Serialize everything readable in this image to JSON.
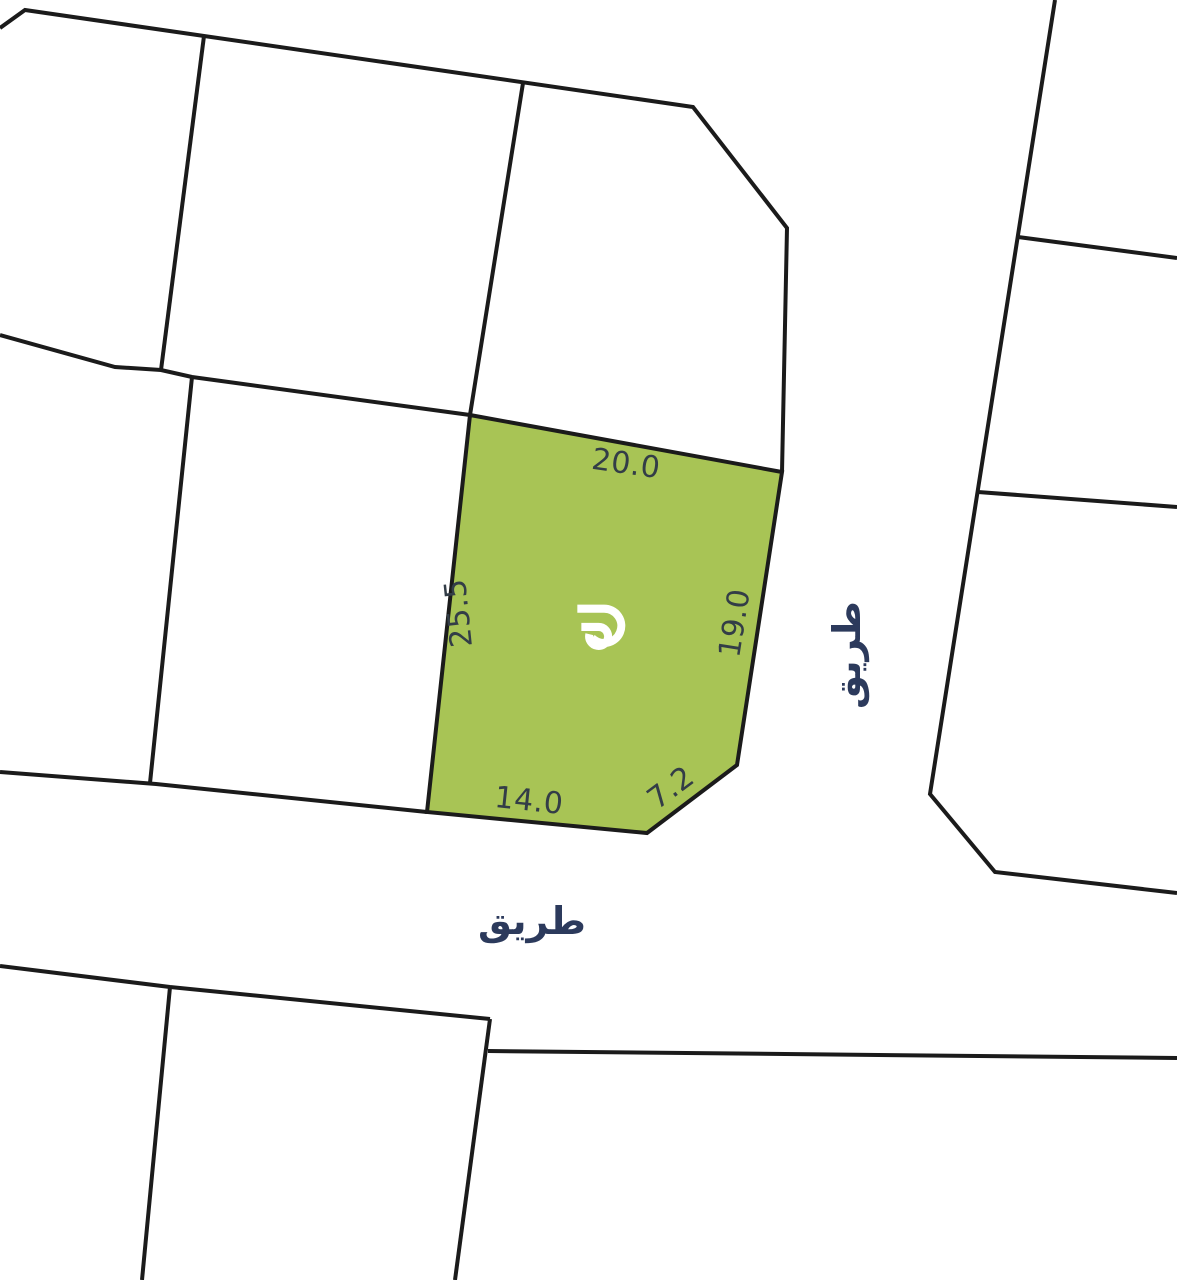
{
  "canvas": {
    "width": 1177,
    "height": 1280,
    "background": "#ffffff",
    "line_color": "#1b1b1b",
    "line_width": 4,
    "dimension_text_color": "#333d47",
    "road_text_color": "#2c3a5c"
  },
  "plot": {
    "name": "highlighted-parcel",
    "fill": "#a8c455",
    "polygon": [
      [
        470,
        415
      ],
      [
        782,
        472
      ],
      [
        737,
        765
      ],
      [
        647,
        833
      ],
      [
        427,
        812
      ]
    ],
    "logo": {
      "icon": "gp-monogram-icon",
      "color": "#ffffff",
      "x": 562,
      "y": 597,
      "size": 73
    },
    "dimensions": {
      "north": {
        "text": "20.0",
        "value": 20.0,
        "x": 626,
        "y": 464,
        "rot": 8
      },
      "west": {
        "text": "25.5",
        "value": 25.5,
        "x": 459,
        "y": 613,
        "rot": -96
      },
      "east": {
        "text": "19.0",
        "value": 19.0,
        "x": 735,
        "y": 623,
        "rot": -81
      },
      "south": {
        "text": "14.0",
        "value": 14.0,
        "x": 529,
        "y": 801,
        "rot": 6
      },
      "southeast": {
        "text": "7.2",
        "value": 7.2,
        "x": 671,
        "y": 788,
        "rot": -37
      }
    }
  },
  "roads": {
    "south": {
      "text": "طريق",
      "x": 532,
      "y": 921,
      "rot": 0,
      "size": 38
    },
    "east": {
      "text": "طريق",
      "x": 847,
      "y": 655,
      "rot": -90,
      "size": 38
    }
  },
  "geometry": {
    "boundaries": [
      {
        "name": "north-block-outline",
        "points": [
          [
            0,
            28
          ],
          [
            25,
            10
          ],
          [
            693,
            107
          ],
          [
            787,
            228
          ],
          [
            782,
            472
          ]
        ]
      },
      {
        "name": "north-parcel-divider-1",
        "points": [
          [
            204,
            36
          ],
          [
            161,
            370
          ]
        ]
      },
      {
        "name": "north-parcel-divider-2",
        "points": [
          [
            523,
            83
          ],
          [
            470,
            415
          ]
        ]
      },
      {
        "name": "mid-west-boundary",
        "points": [
          [
            0,
            335
          ],
          [
            115,
            367
          ],
          [
            161,
            370
          ],
          [
            192,
            377
          ],
          [
            470,
            415
          ]
        ]
      },
      {
        "name": "west-parcel-divider",
        "points": [
          [
            192,
            377
          ],
          [
            150,
            783
          ]
        ]
      },
      {
        "name": "road-south-upper-edge",
        "points": [
          [
            0,
            772
          ],
          [
            156,
            784
          ],
          [
            427,
            812
          ]
        ]
      },
      {
        "name": "road-south-lower-edge",
        "points": [
          [
            0,
            966
          ],
          [
            170,
            987
          ],
          [
            490,
            1019
          ]
        ]
      },
      {
        "name": "southwest-block-east-edge",
        "points": [
          [
            490,
            1019
          ],
          [
            455,
            1280
          ]
        ]
      },
      {
        "name": "southeast-block-top-edge",
        "points": [
          [
            488,
            1051
          ],
          [
            1177,
            1058
          ]
        ]
      },
      {
        "name": "southwest-parcel-divider",
        "points": [
          [
            170,
            987
          ],
          [
            142,
            1280
          ]
        ]
      },
      {
        "name": "east-block-west-edge",
        "points": [
          [
            1055,
            0
          ],
          [
            930,
            794
          ],
          [
            995,
            872
          ],
          [
            1177,
            893
          ]
        ]
      },
      {
        "name": "east-parcel-divider-1",
        "points": [
          [
            1018,
            237
          ],
          [
            1177,
            258
          ]
        ]
      },
      {
        "name": "east-parcel-divider-2",
        "points": [
          [
            978,
            492
          ],
          [
            1177,
            507
          ]
        ]
      }
    ]
  }
}
